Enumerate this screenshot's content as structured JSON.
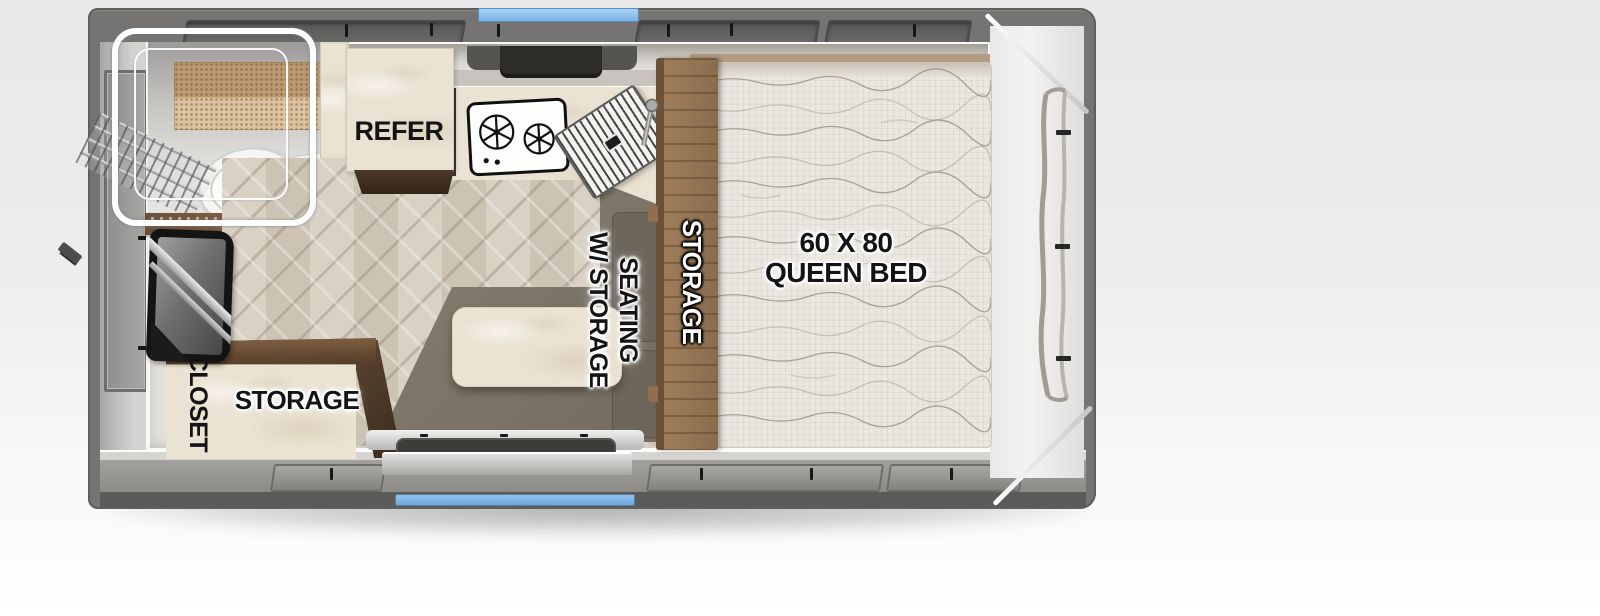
{
  "floorplan": {
    "labels": {
      "refer": "REFER",
      "seating_line1": "SEATING",
      "seating_line2": "W/ STORAGE",
      "bench_storage": "STORAGE",
      "bed_size": "60 X 80",
      "bed_type": "QUEEN BED",
      "closet": "CLOSET",
      "cabinet_storage": "STORAGE"
    },
    "colors": {
      "accent_blue": "#7fb5e8",
      "body_gray": "#767472",
      "interior_wall": "#e4e1dc",
      "cream_surface": "#eae2d3",
      "wood_brown": "#8a6a4f",
      "dinette_gray": "#7c766a"
    },
    "fixtures": [
      "shower-enclosure",
      "toilet",
      "vanity-shelf",
      "ladder",
      "refrigerator",
      "range-hood",
      "two-burner-cooktop",
      "kitchen-sink",
      "faucet",
      "dinette-table",
      "bench-seating",
      "queen-bed",
      "bed-storage",
      "closet",
      "storage-cabinet",
      "tv",
      "entry-step",
      "side-window",
      "rear-window",
      "clearance-light-front",
      "clearance-light-rear"
    ]
  }
}
